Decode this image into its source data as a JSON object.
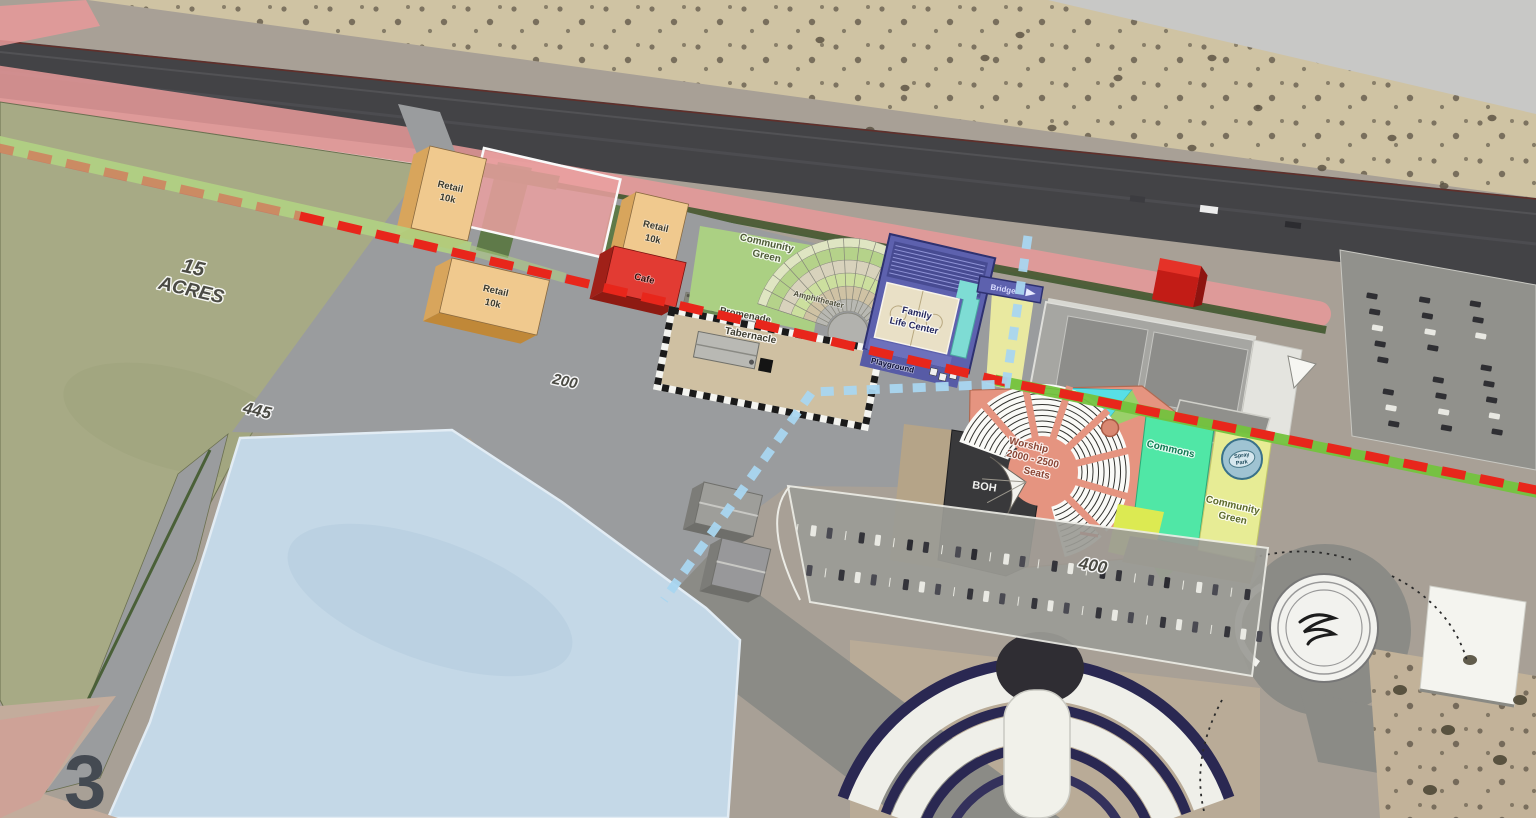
{
  "sheet": {
    "number": "3"
  },
  "labels": {
    "site_area": {
      "line1": "15",
      "line2": "ACRES"
    },
    "dim_west": "445",
    "dim_central": "200",
    "dim_south": "400",
    "retail_a": {
      "line1": "Retail",
      "line2": "10k"
    },
    "retail_b": {
      "line1": "Retail",
      "line2": "10k"
    },
    "retail_c": {
      "line1": "Retail",
      "line2": "10k"
    },
    "cafe": "Cafe",
    "community_green_north": {
      "line1": "Community",
      "line2": "Green"
    },
    "amphitheater": "Amphitheater",
    "promenade": "Promenade",
    "tabernacle": "Tabernacle",
    "family_life_center": {
      "line1": "Family",
      "line2": "Life Center"
    },
    "playground": "Playground",
    "bridge": "Bridge",
    "worship": {
      "line1": "Worship",
      "line2": "2000 - 2500",
      "line3": "Seats"
    },
    "boh": "BOH",
    "commons": "Commons",
    "community_green_east": {
      "line1": "Community",
      "line2": "Green"
    },
    "spray_park": {
      "line1": "Spray",
      "line2": "Park"
    }
  },
  "colors": {
    "red_dashed_line": "#e8261b",
    "blue_dashed_line": "#a9d6f0",
    "retail_building": "#f0c98e",
    "cafe_building": "#e23b33",
    "worship_building": "#e59480",
    "family_life_center": "#5d61ae",
    "commons_green": "#50e7a6",
    "community_green": "#abd083",
    "pink_buffer": "#e89a9a",
    "pond_blue": "#c4d8e7",
    "site_field_olive": "#a7aa85"
  }
}
